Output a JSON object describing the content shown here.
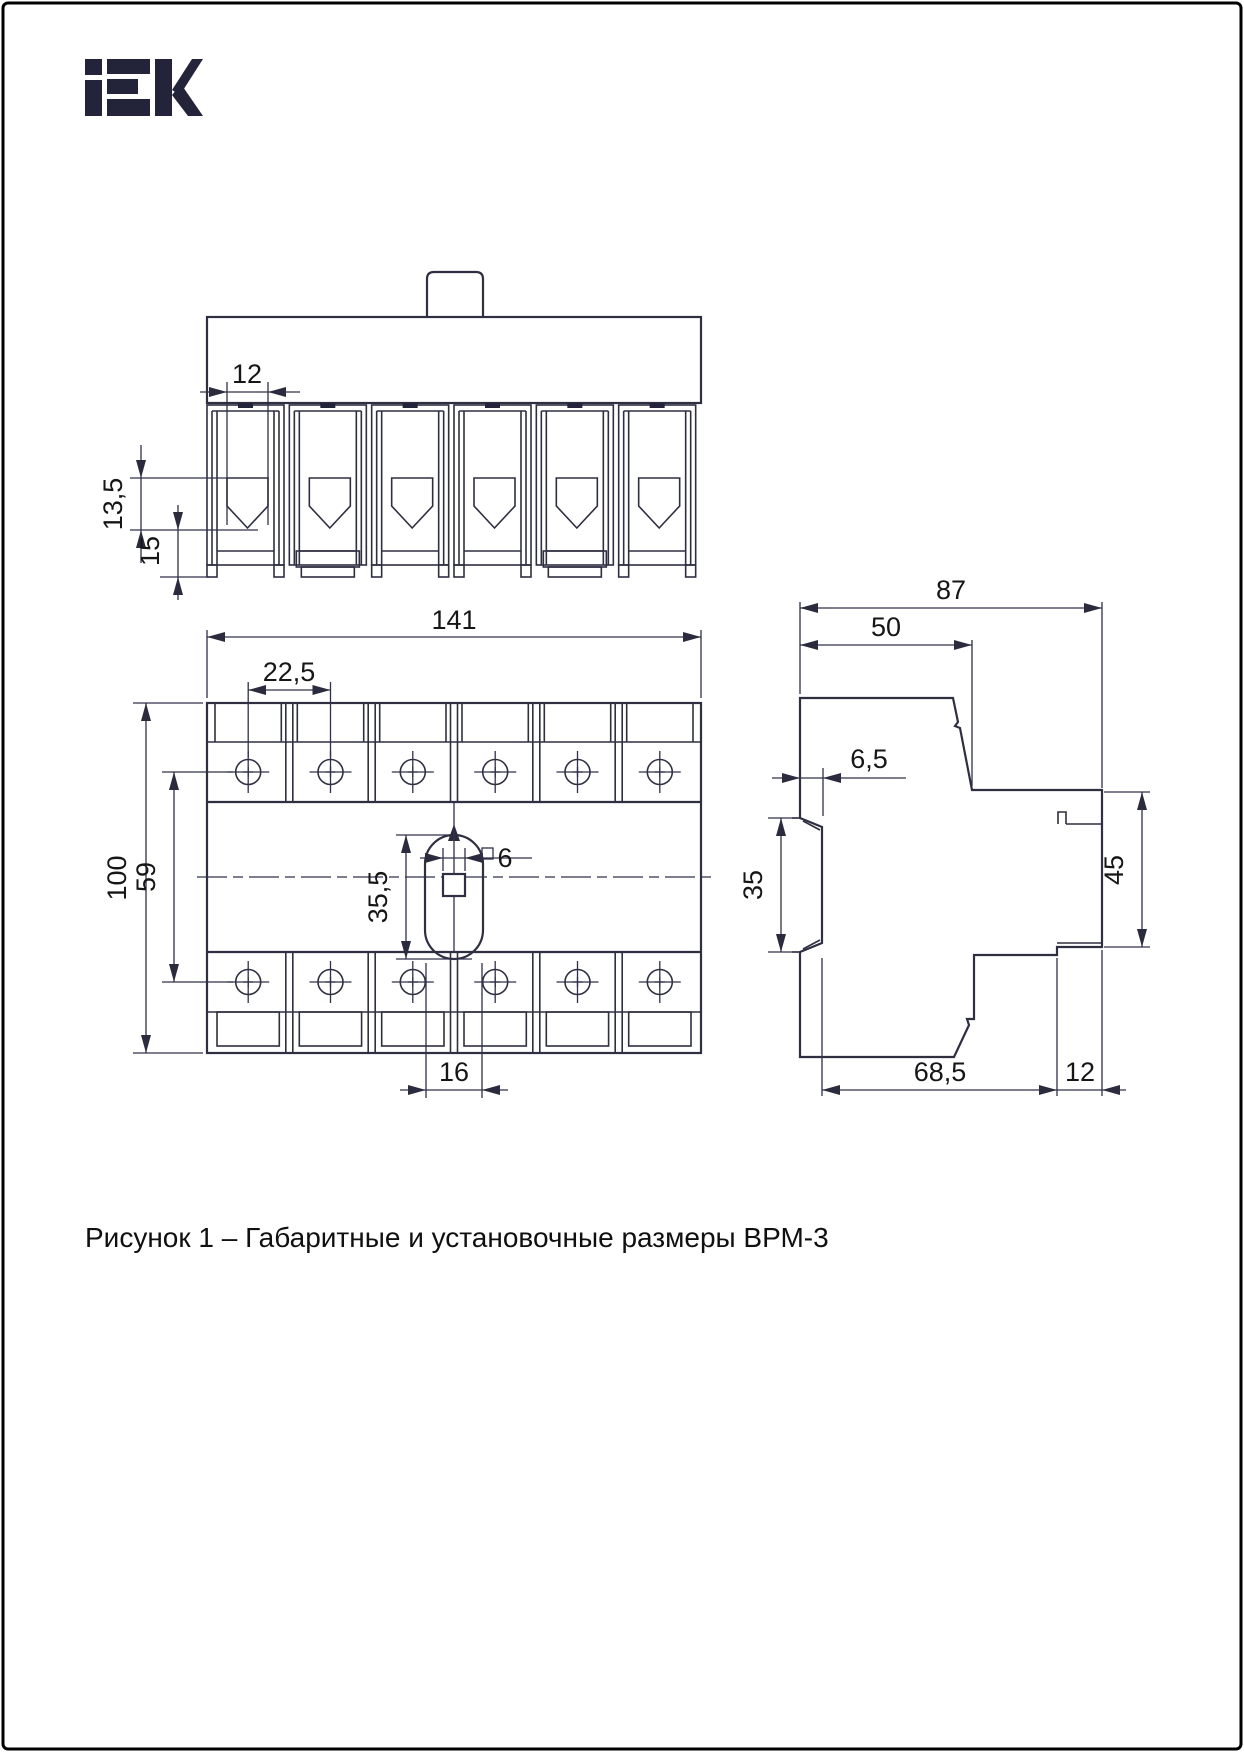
{
  "brand": {
    "name": "IEK"
  },
  "caption": "Рисунок 1 – Габаритные и установочные размеры ВРМ-3",
  "dimensions": {
    "top_view": {
      "terminal_opening_width": "12",
      "terminal_recess_depth": "13,5",
      "terminal_block_depth": "15"
    },
    "front_view": {
      "overall_width": "141",
      "pole_pitch": "22,5",
      "overall_height": "100",
      "screw_rows_spacing": "59",
      "handle_slot_length": "35,5",
      "handle_square_size": "6",
      "handle_slot_width": "16"
    },
    "side_view": {
      "overall_depth": "87",
      "upper_body_depth": "50",
      "din_clip_lip": "6,5",
      "din_rail_height": "35",
      "terminal_block_height": "45",
      "lower_body_depth": "68,5",
      "terminal_block_depth": "12"
    }
  }
}
